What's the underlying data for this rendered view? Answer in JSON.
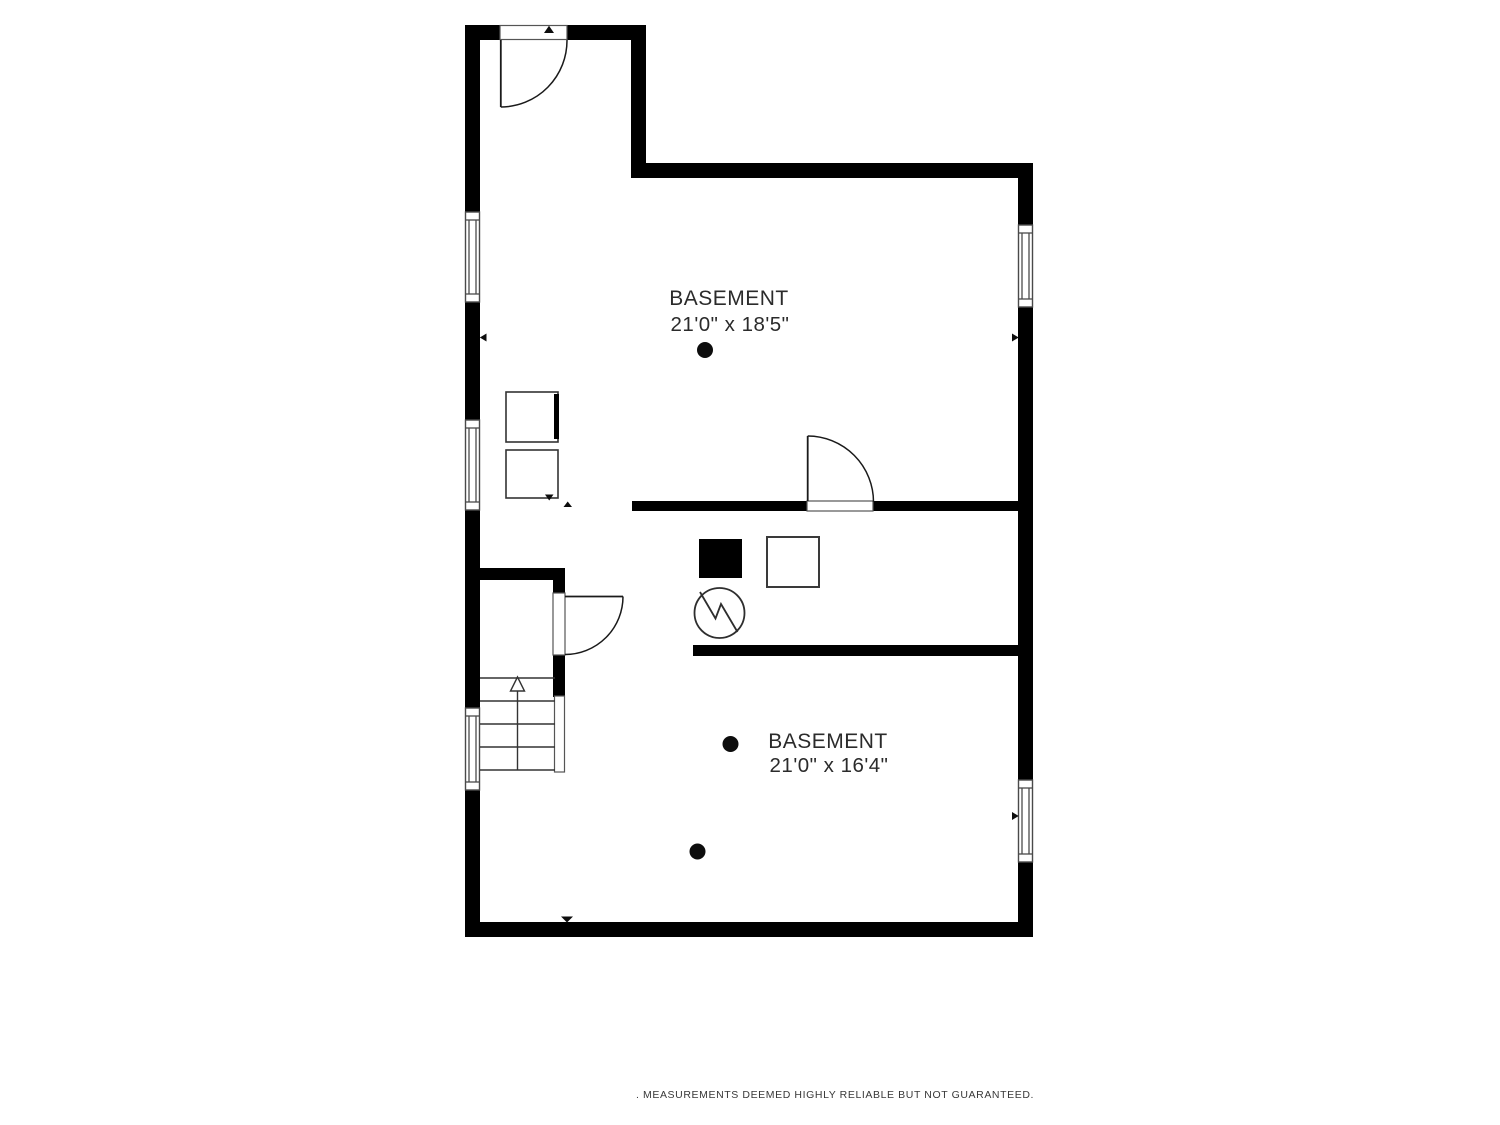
{
  "plan": {
    "title": "Basement floor plan",
    "rooms": [
      {
        "name": "BASEMENT",
        "dimensions": "21'0\" x 18'5\""
      },
      {
        "name": "BASEMENT",
        "dimensions": "21'0\" x 16'4\""
      }
    ],
    "footer": ". MEASUREMENTS DEEMED HIGHLY RELIABLE BUT NOT GUARANTEED.",
    "symbols": {
      "stairs_direction": "up-arrow",
      "electrical_meter": "circle-zigzag",
      "furnace": "filled-square"
    },
    "colors": {
      "wall": "#000000",
      "line": "#333333",
      "text": "#2b2b2b",
      "background": "#ffffff"
    }
  }
}
